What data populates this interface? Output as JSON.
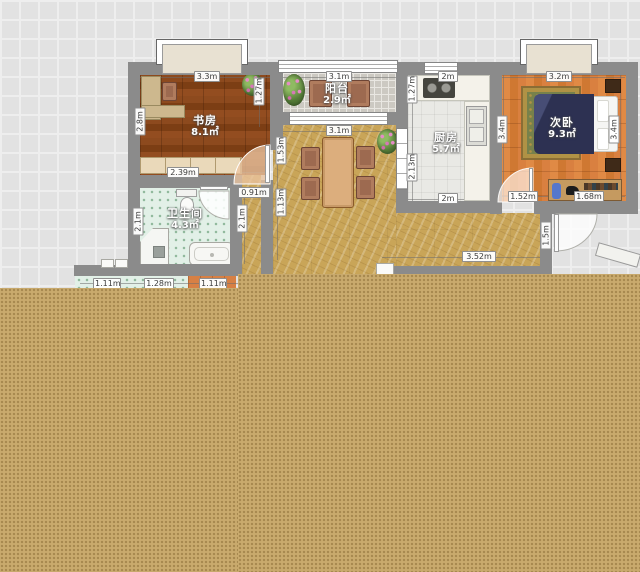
{
  "rooms": {
    "study": {
      "label": "书房",
      "area": "8.1㎡"
    },
    "balcony": {
      "label": "阳台",
      "area": "2.9㎡"
    },
    "kitchen": {
      "label": "厨房",
      "area": "5.7㎡"
    },
    "bedroom": {
      "label": "次卧",
      "area": "9.3㎡"
    },
    "bathroom": {
      "label": "卫生间",
      "area": "4.3㎡"
    }
  },
  "dims": {
    "study_top": "3.3m",
    "study_left": "2.8m",
    "study_right": "1.27m",
    "study_shelf": "2.39m",
    "study_door": "0.91m",
    "balcony_top": "3.1m",
    "dining_top": "3.1m",
    "dining_left_upper": "1.53m",
    "dining_left_lower": "1.13m",
    "kitchen_left_upper": "1.27m",
    "kitchen_left_lower": "2.13m",
    "kitchen_top": "2m",
    "kitchen_bottom": "2m",
    "kitchen_right": "3.4m",
    "bedroom_top": "3.2m",
    "bedroom_right": "3.4m",
    "bedroom_bottom_left": "1.52m",
    "bedroom_bottom_right": "1.68m",
    "bathroom_left": "2.1m",
    "bathroom_right": "2.1m",
    "laundry_left": "1.11m",
    "laundry_mid": "1.28m",
    "laundry_right": "1.11m",
    "hallway_bottom": "3.52m",
    "entry_side": "1.5m"
  },
  "colors": {
    "floor_fill": "#c9aa6d",
    "wall": "#8b8b8b",
    "study_floor": "#87451b",
    "bedroom_floor": "#d57d36",
    "marble_floor": "#c9a558",
    "bath_floor": "#e2f0e7"
  }
}
